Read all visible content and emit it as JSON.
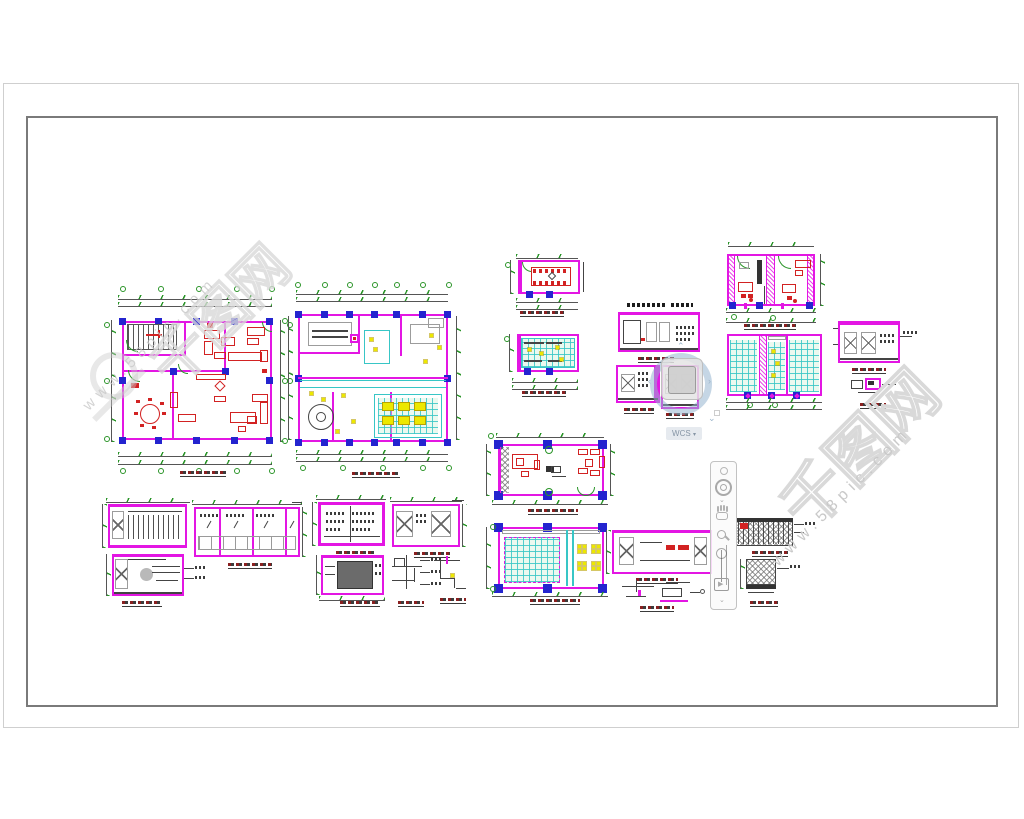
{
  "viewport": {
    "background": "#ffffff"
  },
  "sheet": {
    "border_color": "#cfcfcf"
  },
  "frame": {
    "border_color": "#7a7a7a"
  },
  "viewcube": {
    "wcs_label": "WCS",
    "menu_arrow": "▾",
    "arrows": {
      "up": "⌃",
      "down": "⌄",
      "left": "‹",
      "right": "›"
    }
  },
  "navbar": {
    "tools": [
      "steering-wheel",
      "pan",
      "zoom",
      "orbit",
      "show-motion"
    ],
    "show_motion_glyph": "▶",
    "expand_arrow": "⌄"
  },
  "watermark": {
    "brand": "千图网",
    "url": "www.58pic.com"
  },
  "layers": {
    "wall": "#e316e3",
    "column_marker": "#2424cf",
    "furniture": "#dd2222",
    "dimension": "#2a9428",
    "ceiling_grid": "#38c6c6",
    "lighting": "#ece800",
    "detail": "#444444"
  },
  "drawings": [
    {
      "id": "furniture-floor-plan"
    },
    {
      "id": "ceiling-plan-main"
    },
    {
      "id": "meeting-room-plan"
    },
    {
      "id": "meeting-room-ceiling"
    },
    {
      "id": "elevation-column-mid"
    },
    {
      "id": "two-office-plan"
    },
    {
      "id": "two-office-ceiling"
    },
    {
      "id": "right-elevation"
    },
    {
      "id": "office-plan"
    },
    {
      "id": "office-ceiling"
    },
    {
      "id": "elevations-bottom-left"
    },
    {
      "id": "elevations-bottom-mid"
    },
    {
      "id": "elevation-bottom-right"
    },
    {
      "id": "hatch-details"
    }
  ]
}
